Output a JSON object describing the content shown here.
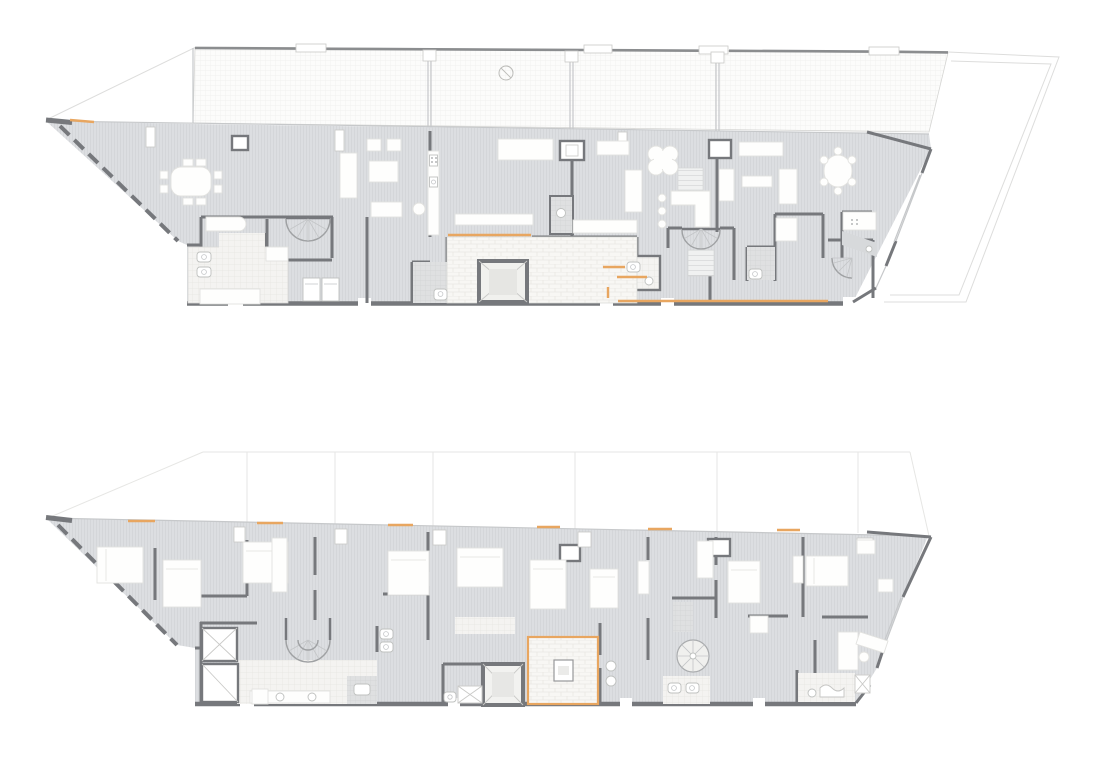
{
  "canvas": {
    "width": 1100,
    "height": 777,
    "background": "#ffffff"
  },
  "figure": {
    "kind": "architectural floor plan drawing",
    "plan_count": 2
  },
  "colors": {
    "wall": "#76787c",
    "wall_light": "#c6c8ca",
    "floor_fill": "#dcdee1",
    "floor_stripe": "#d4d6d9",
    "terrace_fill": "#fcfcfb",
    "terrace_grid": "#eeeeec",
    "tile_fill": "#f4f3f1",
    "tile_grid": "#e6e5e1",
    "tile_dark_fill": "#dfe0e1",
    "tile_dark_grid": "#d2d3d5",
    "furniture_fill": "#fefefd",
    "furniture_stroke": "#e2e2df",
    "accent_orange": "#e8a660",
    "outline": "#dddddc",
    "canvas_bg": "#ffffff"
  },
  "plans": [
    {
      "id": "upper-floor-plan"
    },
    {
      "id": "lower-floor-plan"
    }
  ]
}
